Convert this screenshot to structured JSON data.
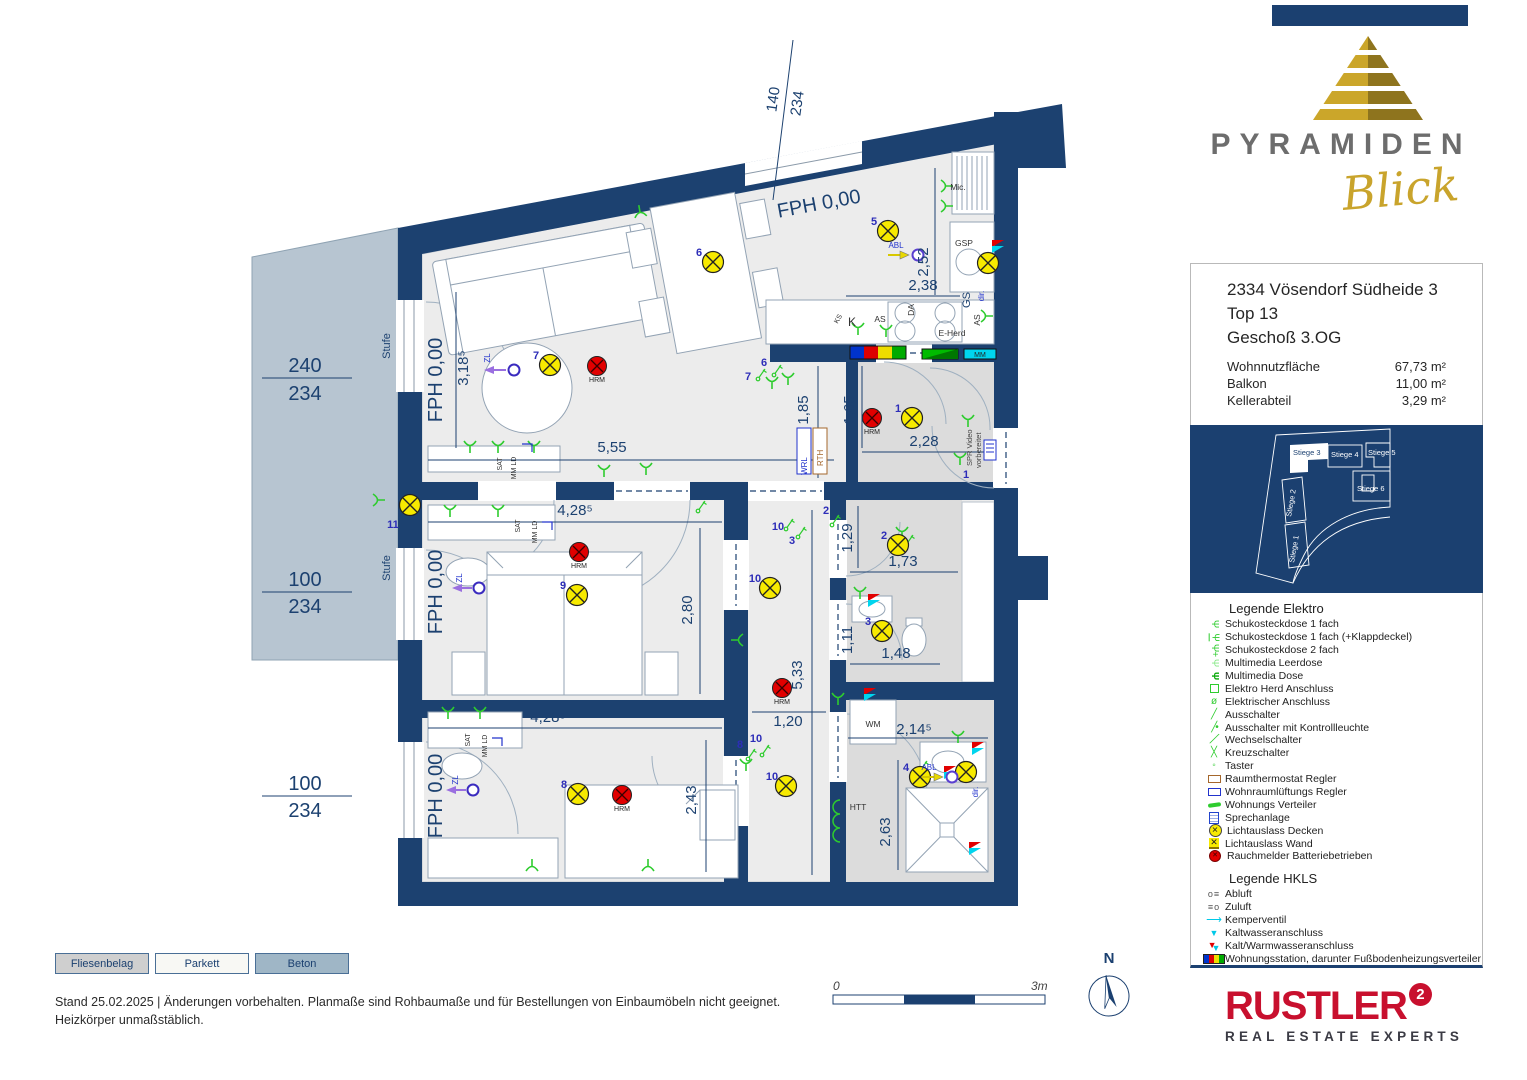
{
  "logo": {
    "brand": "PYRAMIDEN",
    "script": "Blick"
  },
  "info": {
    "address1": "2334 Vösendorf Südheide 3",
    "address2": "Top 13",
    "address3": "Geschoß 3.OG",
    "rows": [
      {
        "label": "Wohnnutzfläche",
        "value": "67,73 m²"
      },
      {
        "label": "Balkon",
        "value": "11,00 m²"
      },
      {
        "label": "Kellerabteil",
        "value": "3,29 m²"
      }
    ]
  },
  "overview": {
    "labels": [
      "Stiege 1",
      "Stiege 2",
      "Stiege 3",
      "Stiege 4",
      "Stiege 5",
      "Stiege 6"
    ]
  },
  "legend_elektro": {
    "title": "Legende Elektro",
    "items": [
      {
        "icon": "socket-1-icon",
        "label": "Schukosteckdose 1 fach"
      },
      {
        "icon": "socket-1-klappdeckel-icon",
        "label": "Schukosteckdose 1 fach (+Klappdeckel)"
      },
      {
        "icon": "socket-2-icon",
        "label": "Schukosteckdose 2 fach"
      },
      {
        "icon": "multimedia-leerdose-icon",
        "label": "Multimedia Leerdose"
      },
      {
        "icon": "multimedia-dose-icon",
        "label": "Multimedia Dose"
      },
      {
        "icon": "herd-anschluss-icon",
        "label": "Elektro Herd Anschluss"
      },
      {
        "icon": "elektrischer-anschluss-icon",
        "label": "Elektrischer Anschluss"
      },
      {
        "icon": "ausschalter-icon",
        "label": "Ausschalter"
      },
      {
        "icon": "ausschalter-kontrollleuchte-icon",
        "label": "Ausschalter mit Kontrollleuchte"
      },
      {
        "icon": "wechselschalter-icon",
        "label": "Wechselschalter"
      },
      {
        "icon": "kreuzschalter-icon",
        "label": "Kreuzschalter"
      },
      {
        "icon": "taster-icon",
        "label": "Taster"
      },
      {
        "icon": "raumthermostat-icon",
        "label": "Raumthermostat Regler"
      },
      {
        "icon": "wohnraumlueftungs-regler-icon",
        "label": "Wohnraumlüftungs Regler"
      },
      {
        "icon": "wohnungs-verteiler-icon",
        "label": "Wohnungs Verteiler"
      },
      {
        "icon": "sprechanlage-icon",
        "label": "Sprechanlage"
      },
      {
        "icon": "lichtauslass-decken-icon",
        "label": "Lichtauslass Decken"
      },
      {
        "icon": "lichtauslass-wand-icon",
        "label": "Lichtauslass Wand"
      },
      {
        "icon": "rauchmelder-icon",
        "label": "Rauchmelder Batteriebetrieben"
      }
    ]
  },
  "legend_hkls": {
    "title": "Legende HKLS",
    "items": [
      {
        "icon": "abluft-icon",
        "label": "Abluft"
      },
      {
        "icon": "zuluft-icon",
        "label": "Zuluft"
      },
      {
        "icon": "kemperventil-icon",
        "label": "Kemperventil"
      },
      {
        "icon": "kaltwasser-icon",
        "label": "Kaltwasseranschluss"
      },
      {
        "icon": "kalt-warmwasser-icon",
        "label": "Kalt/Warmwasseranschluss"
      },
      {
        "icon": "wohnungsstation-icon",
        "label": "Wohnungsstation, darunter Fußbodenheizungsverteiler"
      },
      {
        "icon": "wohnraumlueftung-icon",
        "label": "Wohnraumlüftung"
      }
    ]
  },
  "materials": [
    {
      "label": "Fliesenbelag"
    },
    {
      "label": "Parkett"
    },
    {
      "label": "Beton"
    }
  ],
  "footer": {
    "line1": "Stand 25.02.2025 | Änderungen vorbehalten. Planmaße sind Rohbaumaße und für Bestellungen von Einbaumöbeln nicht geeignet.",
    "line2": "Heizkörper unmaßstäblich."
  },
  "scale": {
    "start": "0",
    "end": "3m"
  },
  "compass": {
    "label": "N"
  },
  "rustler": {
    "name": "RUSTLER",
    "sup": "2",
    "tagline": "REAL ESTATE EXPERTS"
  },
  "plan": {
    "fph": "FPH 0,00",
    "hrm": "HRM",
    "stufe": "Stufe",
    "wm": "WM",
    "htt": "HTT",
    "mic": "Mic.",
    "gsp": "GSP",
    "gs": "GS",
    "dir": "dir.",
    "eherd": "E-Herd",
    "as": "AS",
    "da": "DA",
    "k": "K",
    "ks": "KS",
    "sat": "SAT",
    "mmld": "MM LD",
    "zl": "ZL",
    "abl": "ABL",
    "wrl": "WRL",
    "rth": "RTH",
    "spr1": "SPR Video",
    "spr2": "vorbereitet",
    "mm": "MM",
    "n1": "1",
    "n2": "2",
    "n3": "3",
    "n4": "4",
    "n5": "5",
    "n6": "6",
    "n7": "7",
    "n8": "8",
    "n9": "9",
    "n10": "10",
    "n11": "11",
    "d140": "140",
    "d234": "234",
    "d240": "240",
    "d100": "100",
    "d555": "5,55",
    "d4285": "4,28⁵",
    "d280": "2,80",
    "d3185": "3,18⁵",
    "d238": "2,38",
    "d252": "2,52",
    "d185": "1,85",
    "d165": "1,65",
    "d228": "2,28",
    "d173": "1,73",
    "d129": "1,29",
    "d111": "1,11",
    "d148": "1,48",
    "d533": "5,33",
    "d120": "1,20",
    "d243": "2,43",
    "d2145": "2,14⁵",
    "d263": "2,63"
  },
  "colors": {
    "wall": "#1c4170",
    "balcony": "#b7c5d1",
    "lamp": "#f7ea00",
    "smoke": "#e10000",
    "green": "#2ecc2e",
    "rustler_red": "#c8102e",
    "gold": "#c9a42c"
  }
}
